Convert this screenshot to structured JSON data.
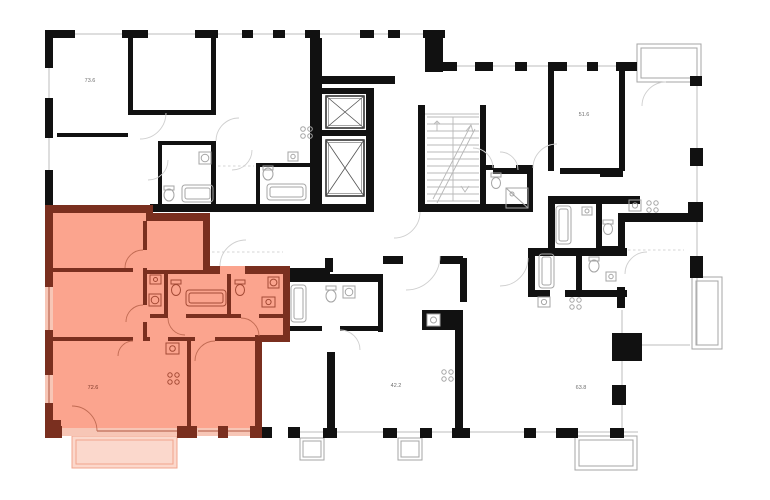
{
  "plan": {
    "type": "building-floor-plan",
    "background": "#ffffff",
    "highlighted_apartment": {
      "area_label": "72.6"
    },
    "apartments": [
      {
        "name": "apartment-top-left",
        "area_label": "73.6",
        "highlighted": false
      },
      {
        "name": "apartment-top-right",
        "area_label": "51.6",
        "highlighted": false
      },
      {
        "name": "apartment-bottom-left",
        "area_label": "72.6",
        "highlighted": true
      },
      {
        "name": "apartment-bottom-mid",
        "area_label": "42.2",
        "highlighted": false
      },
      {
        "name": "apartment-bottom-right",
        "area_label": "63.8",
        "highlighted": false
      }
    ],
    "colors": {
      "wall": "#111111",
      "highlight_fill": "#FBA48E",
      "highlight_wall": "#7A2F1F",
      "highlight_window": "#F7C6B6",
      "highlight_balcony": "#FBD8CC",
      "line_gray": "#bcbcbc",
      "fixture_gray": "#a5a5a5",
      "label_gray": "#6f6f6f",
      "highlight_label": "#7c3727"
    },
    "icons": [
      "elevator-icon",
      "staircase-icon",
      "bathtub-icon",
      "toilet-icon",
      "sink-icon",
      "stove-icon",
      "washing-machine-icon",
      "shower-icon",
      "door-arc-icon",
      "balcony",
      "window"
    ]
  }
}
